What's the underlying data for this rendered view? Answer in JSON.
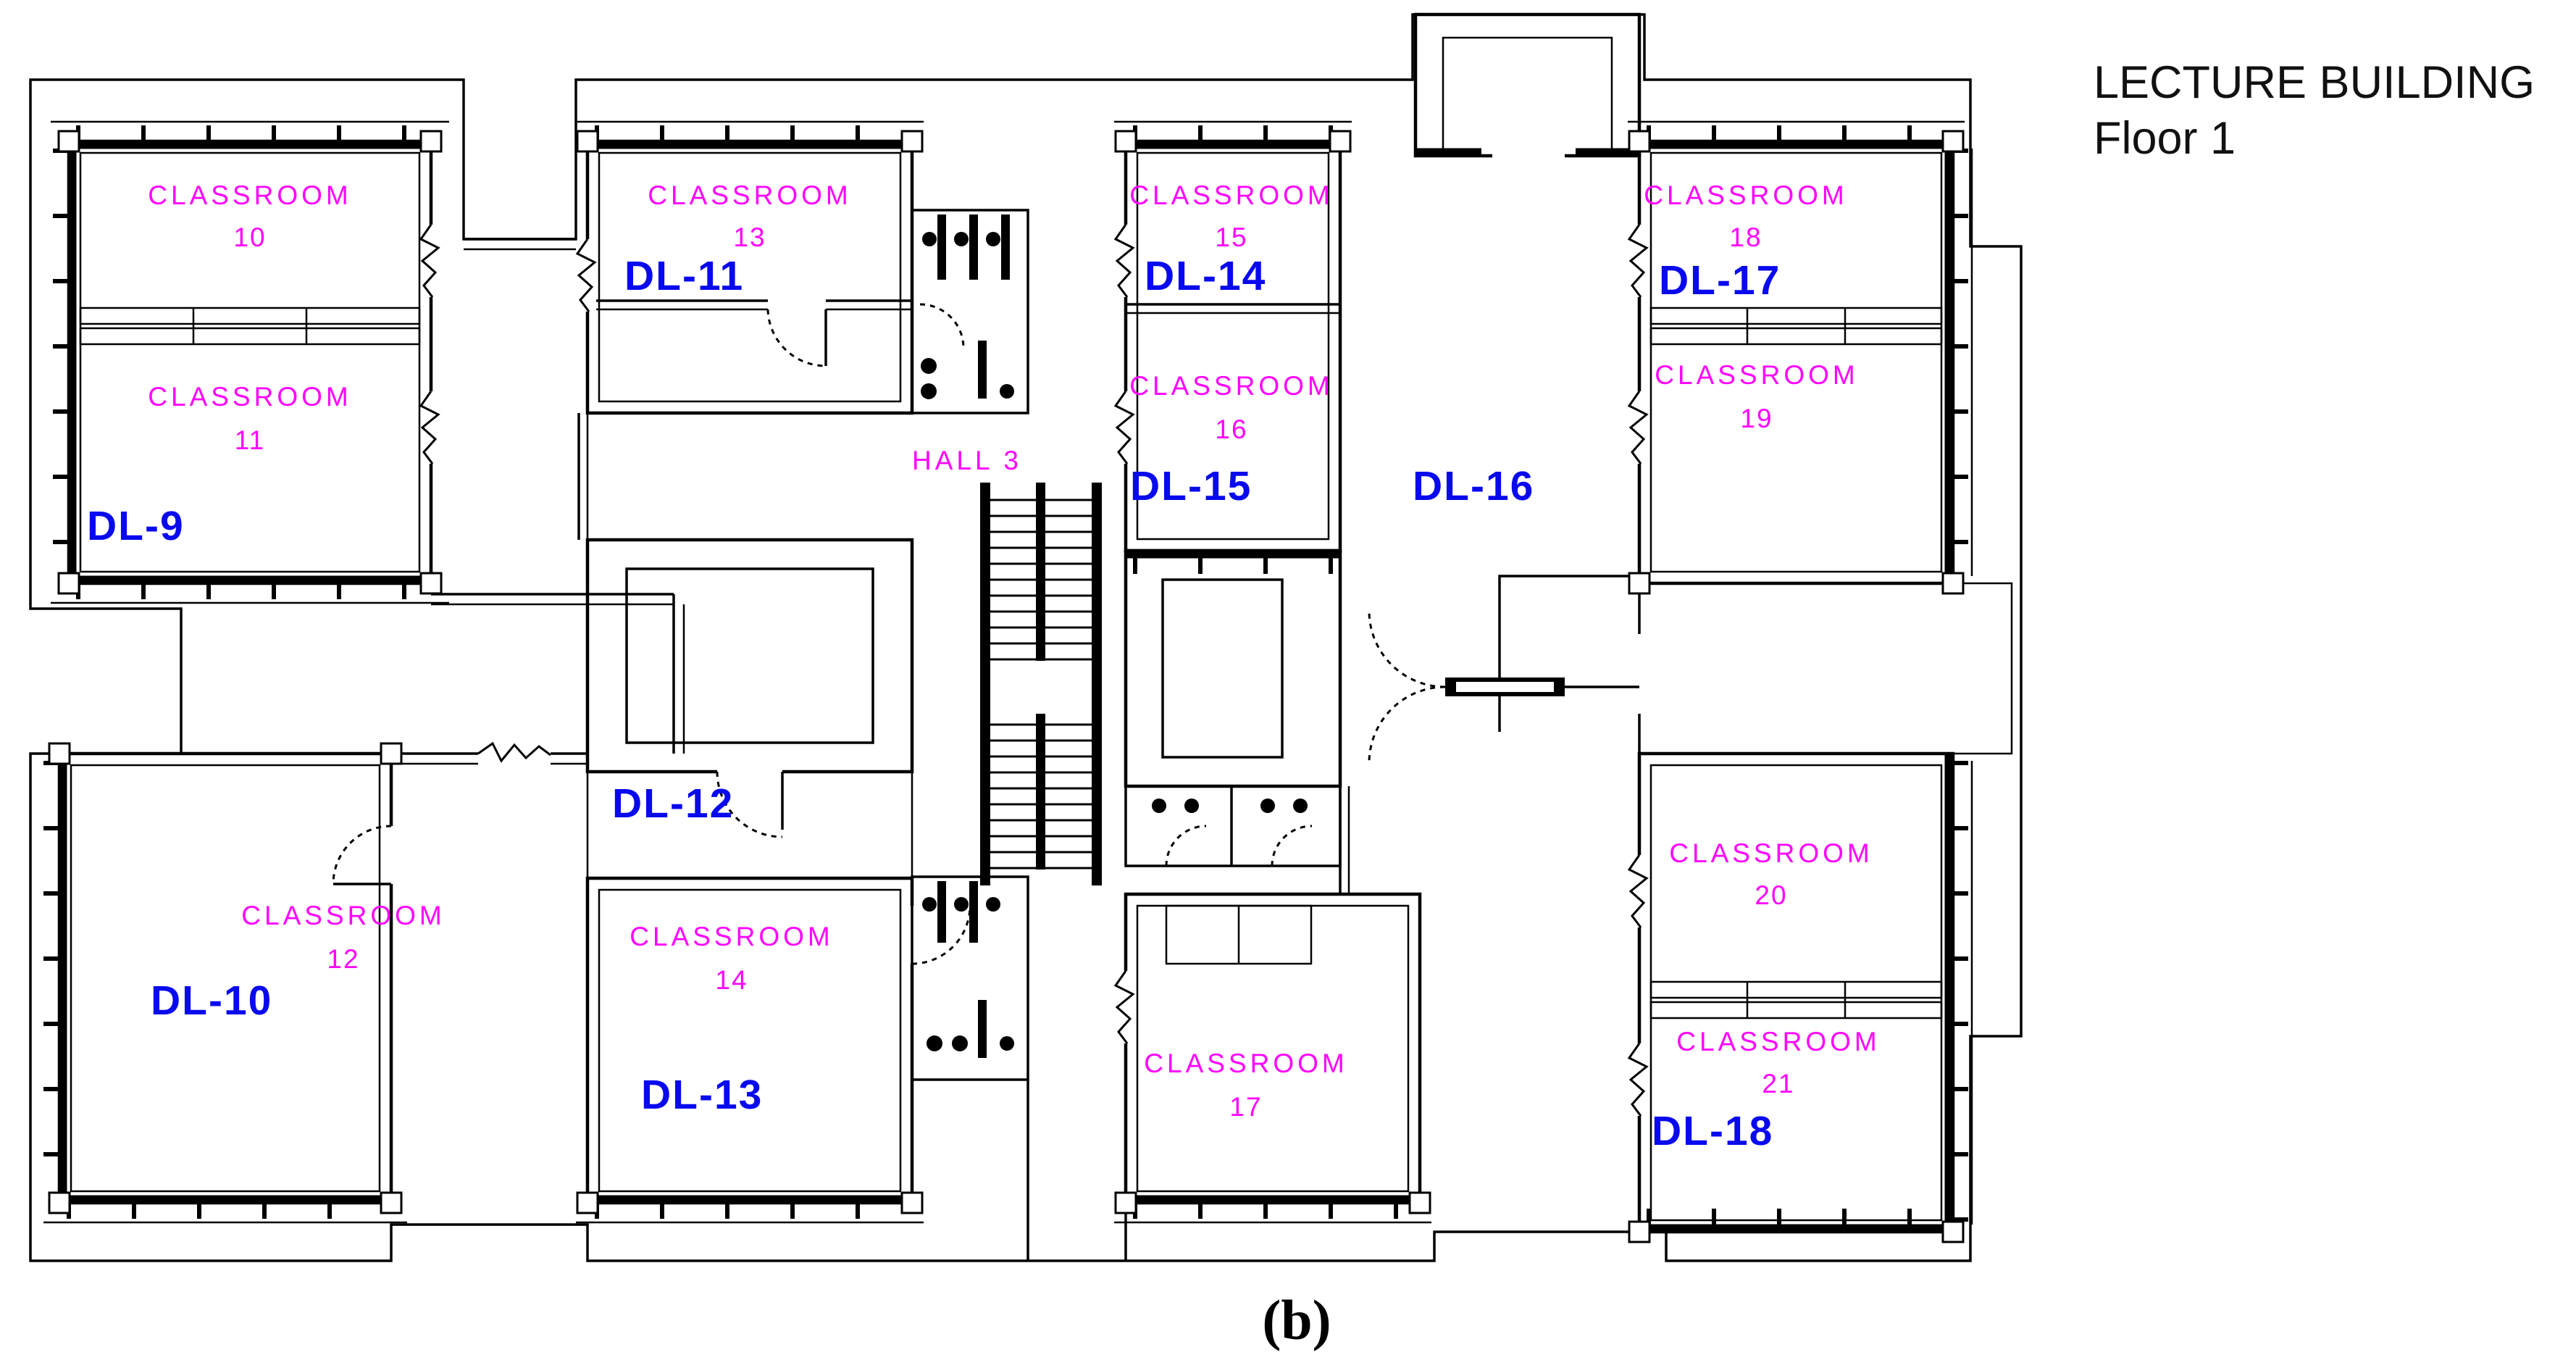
{
  "title": {
    "line1": "LECTURE BUILDING",
    "line2": "Floor 1"
  },
  "caption": "(b)",
  "colors": {
    "room_label": "#FF00FF",
    "dl_label": "#0909EE",
    "walls": "#000000",
    "background": "#FFFFFF"
  },
  "rooms": [
    {
      "id": "classroom-10",
      "name": "CLASSROOM",
      "number": "10"
    },
    {
      "id": "classroom-11",
      "name": "CLASSROOM",
      "number": "11"
    },
    {
      "id": "classroom-13",
      "name": "CLASSROOM",
      "number": "13"
    },
    {
      "id": "classroom-15",
      "name": "CLASSROOM",
      "number": "15"
    },
    {
      "id": "classroom-16",
      "name": "CLASSROOM",
      "number": "16"
    },
    {
      "id": "classroom-18",
      "name": "CLASSROOM",
      "number": "18"
    },
    {
      "id": "classroom-19",
      "name": "CLASSROOM",
      "number": "19"
    },
    {
      "id": "classroom-12",
      "name": "CLASSROOM",
      "number": "12"
    },
    {
      "id": "classroom-14",
      "name": "CLASSROOM",
      "number": "14"
    },
    {
      "id": "classroom-17",
      "name": "CLASSROOM",
      "number": "17"
    },
    {
      "id": "classroom-20",
      "name": "CLASSROOM",
      "number": "20"
    },
    {
      "id": "classroom-21",
      "name": "CLASSROOM",
      "number": "21"
    }
  ],
  "hall": {
    "label": "HALL 3"
  },
  "dl_labels": {
    "dl9": "DL-9",
    "dl10": "DL-10",
    "dl11": "DL-11",
    "dl12": "DL-12",
    "dl13": "DL-13",
    "dl14": "DL-14",
    "dl15": "DL-15",
    "dl16": "DL-16",
    "dl17": "DL-17",
    "dl18": "DL-18"
  }
}
